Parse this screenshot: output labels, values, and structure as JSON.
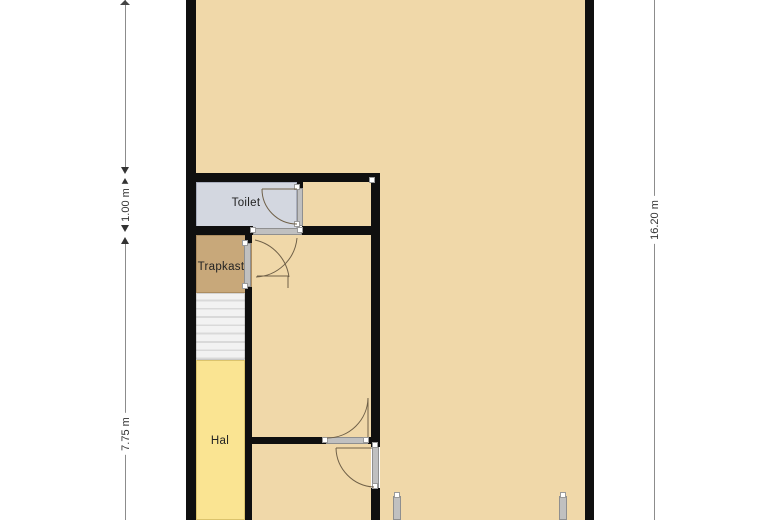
{
  "plan": {
    "rooms": {
      "toilet": {
        "label": "Toilet"
      },
      "trapkast": {
        "label": "Trapkast"
      },
      "hal": {
        "label": "Hal"
      }
    },
    "dimensions": {
      "left_top": {
        "label": "1.00 m"
      },
      "left_bottom": {
        "label": "7.75 m"
      },
      "right": {
        "label": "16.20 m"
      }
    }
  },
  "colors": {
    "wall": "#0f0f0f",
    "room_beige": "#f0d8a9",
    "toilet": "#d3d7e0",
    "trapkast": "#c8a87a",
    "hal": "#fae492",
    "stairs_light": "#f2f2f2",
    "stairs_dark": "#d9d9d9",
    "frame": "#c0c0c0",
    "frame_border": "#8f8f8f",
    "arc": "#6f6048",
    "dim_line": "#8c8c8c",
    "dim_text": "#333333",
    "label_text": "#222222",
    "bg": "#ffffff"
  }
}
